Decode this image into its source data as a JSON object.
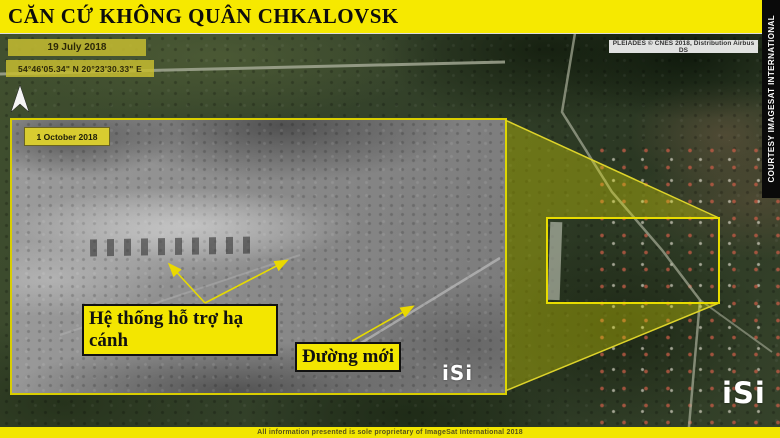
{
  "header": {
    "title": "CĂN CỨ KHÔNG QUÂN CHKALOVSK"
  },
  "side_credit": "COURTESY IMAGESAT INTERNATIONAL",
  "source_credit": "PLEIADES © CNES 2018, Distribution Airbus DS",
  "footer_text": "All information presented is sole proprietary of ImageSat International 2018",
  "main_view": {
    "date": "19 July 2018",
    "coordinates": "54°46'05.34\" N  20°23'30.33\" E",
    "logo": "iSi"
  },
  "inset": {
    "date": "1 October 2018",
    "logo": "iSi"
  },
  "annotations": {
    "landing_system": "Hệ thống hỗ trợ hạ cánh",
    "new_road": "Đường mới"
  },
  "icons": {
    "north_arrow": "▲"
  },
  "colors": {
    "accent_yellow": "#f6e900",
    "callout_yellow": "#f3e600",
    "highlight_stroke": "#e8dc00",
    "beam_fill": "rgba(235,235,0,0.33)",
    "credit_strip_bg": "#0a0a0a"
  }
}
